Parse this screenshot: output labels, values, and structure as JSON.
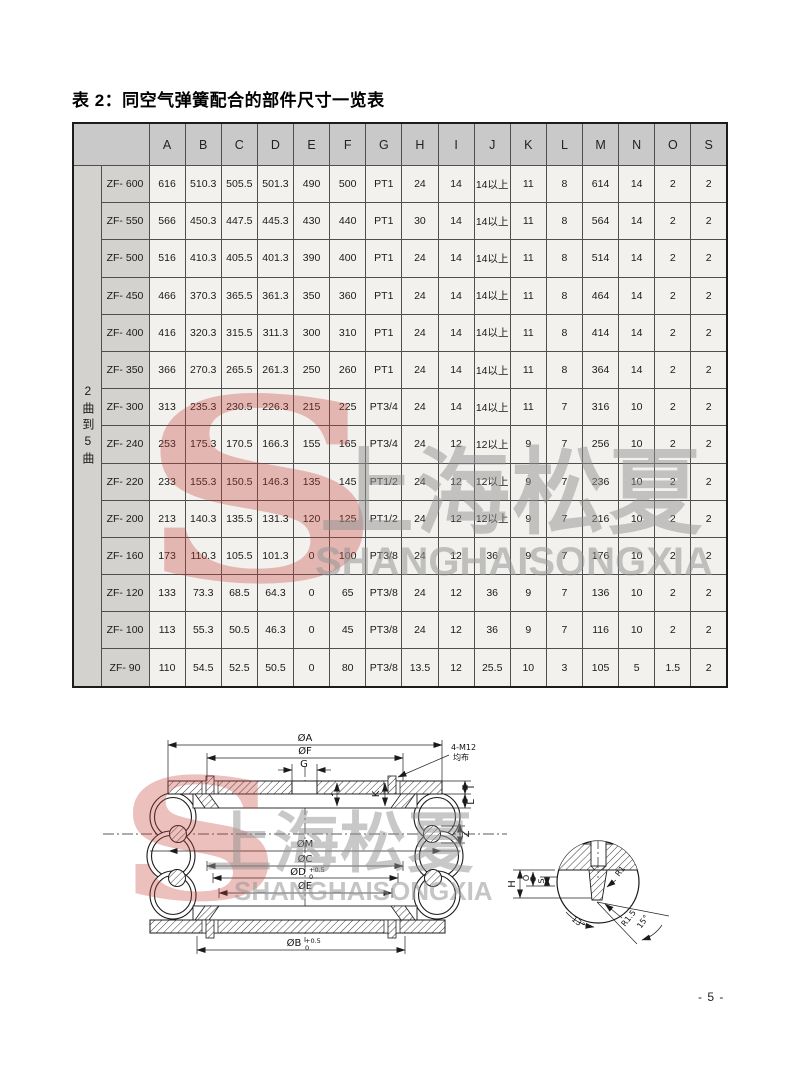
{
  "page": {
    "title": "表 2：同空气弹簧配合的部件尺寸一览表",
    "page_number": "- 5 -"
  },
  "watermark": {
    "logo_letter": "S",
    "cn": "上海松夏",
    "en": "SHANGHAISONGXIA",
    "red": "#c64036",
    "gray": "#919191"
  },
  "table": {
    "row_group_label": "2曲到5曲",
    "columns": [
      "A",
      "B",
      "C",
      "D",
      "E",
      "F",
      "G",
      "H",
      "I",
      "J",
      "K",
      "L",
      "M",
      "N",
      "O",
      "S"
    ],
    "rows": [
      {
        "model": "ZF- 600",
        "values": [
          "616",
          "510.3",
          "505.5",
          "501.3",
          "490",
          "500",
          "PT1",
          "24",
          "14",
          "14以上",
          "11",
          "8",
          "614",
          "14",
          "2",
          "2"
        ]
      },
      {
        "model": "ZF- 550",
        "values": [
          "566",
          "450.3",
          "447.5",
          "445.3",
          "430",
          "440",
          "PT1",
          "30",
          "14",
          "14以上",
          "11",
          "8",
          "564",
          "14",
          "2",
          "2"
        ]
      },
      {
        "model": "ZF- 500",
        "values": [
          "516",
          "410.3",
          "405.5",
          "401.3",
          "390",
          "400",
          "PT1",
          "24",
          "14",
          "14以上",
          "11",
          "8",
          "514",
          "14",
          "2",
          "2"
        ]
      },
      {
        "model": "ZF- 450",
        "values": [
          "466",
          "370.3",
          "365.5",
          "361.3",
          "350",
          "360",
          "PT1",
          "24",
          "14",
          "14以上",
          "11",
          "8",
          "464",
          "14",
          "2",
          "2"
        ]
      },
      {
        "model": "ZF- 400",
        "values": [
          "416",
          "320.3",
          "315.5",
          "311.3",
          "300",
          "310",
          "PT1",
          "24",
          "14",
          "14以上",
          "11",
          "8",
          "414",
          "14",
          "2",
          "2"
        ]
      },
      {
        "model": "ZF- 350",
        "values": [
          "366",
          "270.3",
          "265.5",
          "261.3",
          "250",
          "260",
          "PT1",
          "24",
          "14",
          "14以上",
          "11",
          "8",
          "364",
          "14",
          "2",
          "2"
        ]
      },
      {
        "model": "ZF- 300",
        "values": [
          "313",
          "235.3",
          "230.5",
          "226.3",
          "215",
          "225",
          "PT3/4",
          "24",
          "14",
          "14以上",
          "11",
          "7",
          "316",
          "10",
          "2",
          "2"
        ]
      },
      {
        "model": "ZF- 240",
        "values": [
          "253",
          "175.3",
          "170.5",
          "166.3",
          "155",
          "165",
          "PT3/4",
          "24",
          "12",
          "12以上",
          "9",
          "7",
          "256",
          "10",
          "2",
          "2"
        ]
      },
      {
        "model": "ZF- 220",
        "values": [
          "233",
          "155.3",
          "150.5",
          "146.3",
          "135",
          "145",
          "PT1/2",
          "24",
          "12",
          "12以上",
          "9",
          "7",
          "236",
          "10",
          "2",
          "2"
        ]
      },
      {
        "model": "ZF- 200",
        "values": [
          "213",
          "140.3",
          "135.5",
          "131.3",
          "120",
          "125",
          "PT1/2",
          "24",
          "12",
          "12以上",
          "9",
          "7",
          "216",
          "10",
          "2",
          "2"
        ]
      },
      {
        "model": "ZF- 160",
        "values": [
          "173",
          "110.3",
          "105.5",
          "101.3",
          "0",
          "100",
          "PT3/8",
          "24",
          "12",
          "36",
          "9",
          "7",
          "176",
          "10",
          "2",
          "2"
        ]
      },
      {
        "model": "ZF- 120",
        "values": [
          "133",
          "73.3",
          "68.5",
          "64.3",
          "0",
          "65",
          "PT3/8",
          "24",
          "12",
          "36",
          "9",
          "7",
          "136",
          "10",
          "2",
          "2"
        ]
      },
      {
        "model": "ZF- 100",
        "values": [
          "113",
          "55.3",
          "50.5",
          "46.3",
          "0",
          "45",
          "PT3/8",
          "24",
          "12",
          "36",
          "9",
          "7",
          "116",
          "10",
          "2",
          "2"
        ]
      },
      {
        "model": "ZF- 90",
        "values": [
          "110",
          "54.5",
          "52.5",
          "50.5",
          "0",
          "80",
          "PT3/8",
          "13.5",
          "12",
          "25.5",
          "10",
          "3",
          "105",
          "5",
          "1.5",
          "2"
        ]
      }
    ]
  },
  "diagram": {
    "labels": {
      "a": "ØA",
      "f": "ØF",
      "g": "G",
      "m": "ØM",
      "c": "ØC",
      "d": "ØD",
      "e": "ØE",
      "b": "ØB",
      "tol_up": "+0.5",
      "tol_dn": "0",
      "j": "J",
      "k": "K",
      "i": "I",
      "l": "L",
      "z": "Z",
      "bolt1": "4-M12",
      "bolt2": "均布",
      "h": "H",
      "o": "O",
      "s": "S",
      "r1": "R1",
      "r15": "R1.5",
      "a13": "13°",
      "a15": "15°"
    }
  }
}
